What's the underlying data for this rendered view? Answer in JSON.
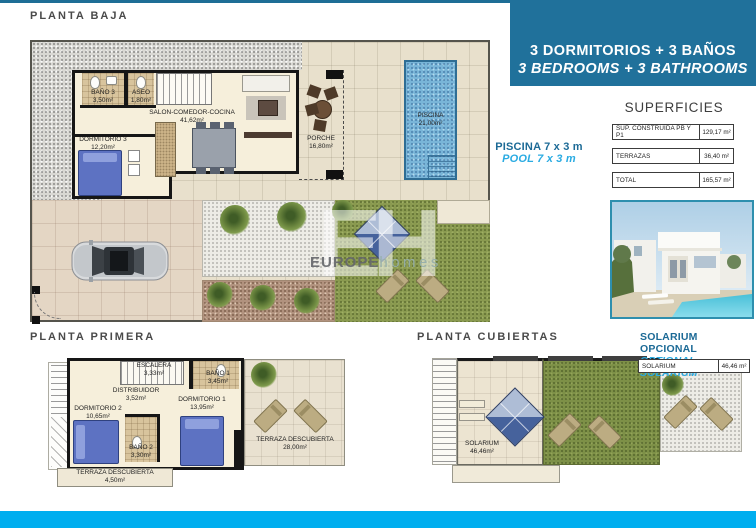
{
  "colors": {
    "header_box": "#20719b",
    "accent_cyan": "#00aeef",
    "text_dark_blue": "#1c6a96",
    "text_cyan": "#2aabe2"
  },
  "header": {
    "line1": "3 DORMITORIOS + 3 BAÑOS",
    "line2": "3 BEDROOMS + 3 BATHROOMS"
  },
  "pool_note": {
    "es": "PISCINA 7 x 3 m",
    "en": "POOL 7 x 3 m"
  },
  "superficies": {
    "title": "SUPERFICIES",
    "rows": [
      {
        "label": "SUP. CONSTRUIDA PB Y P1",
        "value": "129,17 m²"
      },
      {
        "label": "TERRAZAS",
        "value": "36,40 m²"
      },
      {
        "label": "TOTAL",
        "value": "165,57 m²"
      }
    ]
  },
  "solarium_note": {
    "es": "SOLARIUM OPCIONAL",
    "en": "OPTIONAL SOLARIUM"
  },
  "solarium_table": {
    "label": "SOLARIUM",
    "value": "46,46 m²"
  },
  "watermark": {
    "initials": "EH",
    "brand_bold": "EUROPE",
    "brand_light": "homes"
  },
  "plans": {
    "planta_baja": {
      "title": "PLANTA BAJA",
      "rooms": [
        {
          "name": "BAÑO 3",
          "area": "3,50m²"
        },
        {
          "name": "ASEO",
          "area": "1,80m²"
        },
        {
          "name": "SALON-COMEDOR-COCINA",
          "area": "41,62m²"
        },
        {
          "name": "DORMITORIO 3",
          "area": "12,20m²"
        },
        {
          "name": "PORCHE",
          "area": "16,80m²"
        },
        {
          "name": "PISCINA",
          "area": "21,00m²"
        }
      ]
    },
    "planta_primera": {
      "title": "PLANTA PRIMERA",
      "rooms": [
        {
          "name": "ESCALERA",
          "area": "3,33m²"
        },
        {
          "name": "DISTRIBUIDOR",
          "area": "3,52m²"
        },
        {
          "name": "BAÑO 1",
          "area": "3,45m²"
        },
        {
          "name": "DORMITORIO 1",
          "area": "13,95m²"
        },
        {
          "name": "DORMITORIO 2",
          "area": "10,65m²"
        },
        {
          "name": "BAÑO 2",
          "area": "3,30m²"
        },
        {
          "name": "TERRAZA DESCUBIERTA",
          "area": "28,00m²"
        },
        {
          "name": "TERRAZA DESCUBIERTA",
          "area": "4,50m²"
        }
      ]
    },
    "planta_cubiertas": {
      "title": "PLANTA CUBIERTAS",
      "rooms": [
        {
          "name": "SOLARIUM",
          "area": "46,46m²"
        }
      ]
    }
  }
}
